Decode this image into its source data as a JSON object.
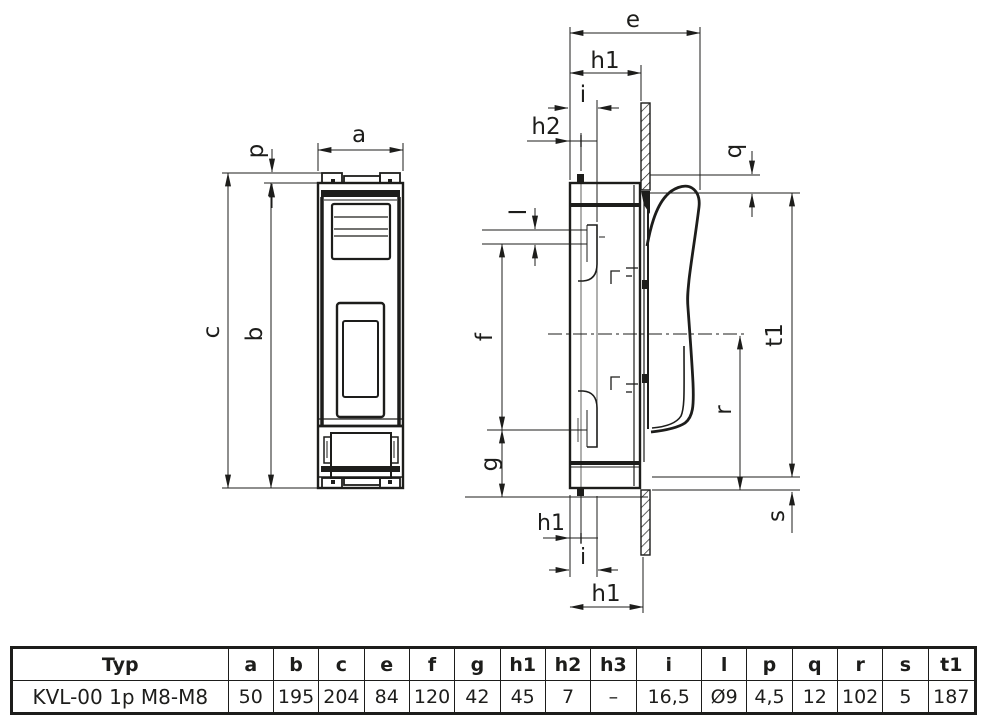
{
  "drawing": {
    "front_view_labels": {
      "a": "a",
      "p": "p",
      "c": "c",
      "b": "b"
    },
    "side_view_labels": {
      "e": "e",
      "h1_top": "h1",
      "i_top": "i",
      "h2": "h2",
      "q": "q",
      "l": "l",
      "f": "f",
      "g": "g",
      "t1": "t1",
      "r": "r",
      "s": "s",
      "h1_small_bottom": "h1",
      "i_bottom": "i",
      "h1_bottom": "h1"
    }
  },
  "table": {
    "headers": [
      "Typ",
      "a",
      "b",
      "c",
      "e",
      "f",
      "g",
      "h1",
      "h2",
      "h3",
      "i",
      "l",
      "p",
      "q",
      "r",
      "s",
      "t1"
    ],
    "rows": [
      {
        "typ": "KVL-00 1p M8-M8",
        "values": [
          "50",
          "195",
          "204",
          "84",
          "120",
          "42",
          "45",
          "7",
          "–",
          "16,5",
          "Ø9",
          "4,5",
          "12",
          "102",
          "5",
          "187"
        ]
      }
    ]
  },
  "colors": {
    "line": "#1d1d1b",
    "background": "#ffffff"
  }
}
